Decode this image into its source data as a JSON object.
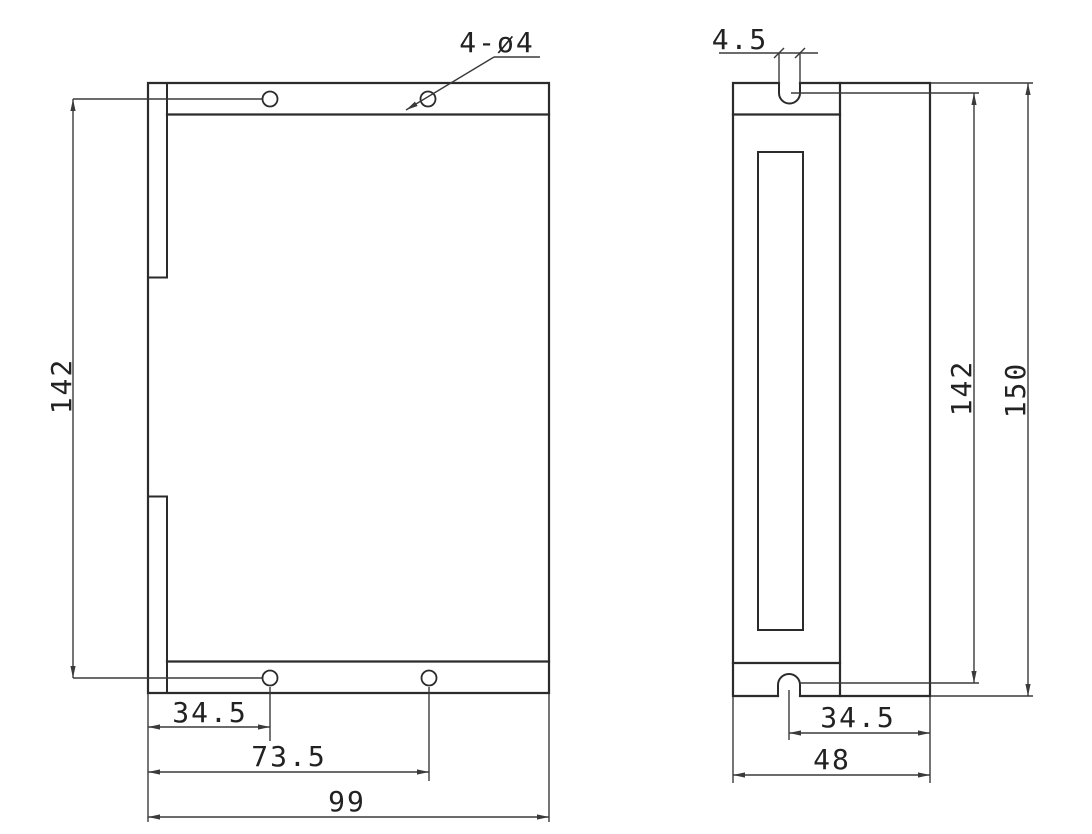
{
  "front_view": {
    "hole_callout": "4-ø4",
    "height": "142",
    "hole_offset": "34.5",
    "hole_span": "73.5",
    "width": "99"
  },
  "side_view": {
    "slot_width": "4.5",
    "slot_center_height": "142",
    "overall_height": "150",
    "slot_offset": "34.5",
    "depth": "48"
  },
  "colors": {
    "line": "#2b2b2b",
    "dimension_line": "#3a3a3a",
    "background": "#ffffff"
  }
}
